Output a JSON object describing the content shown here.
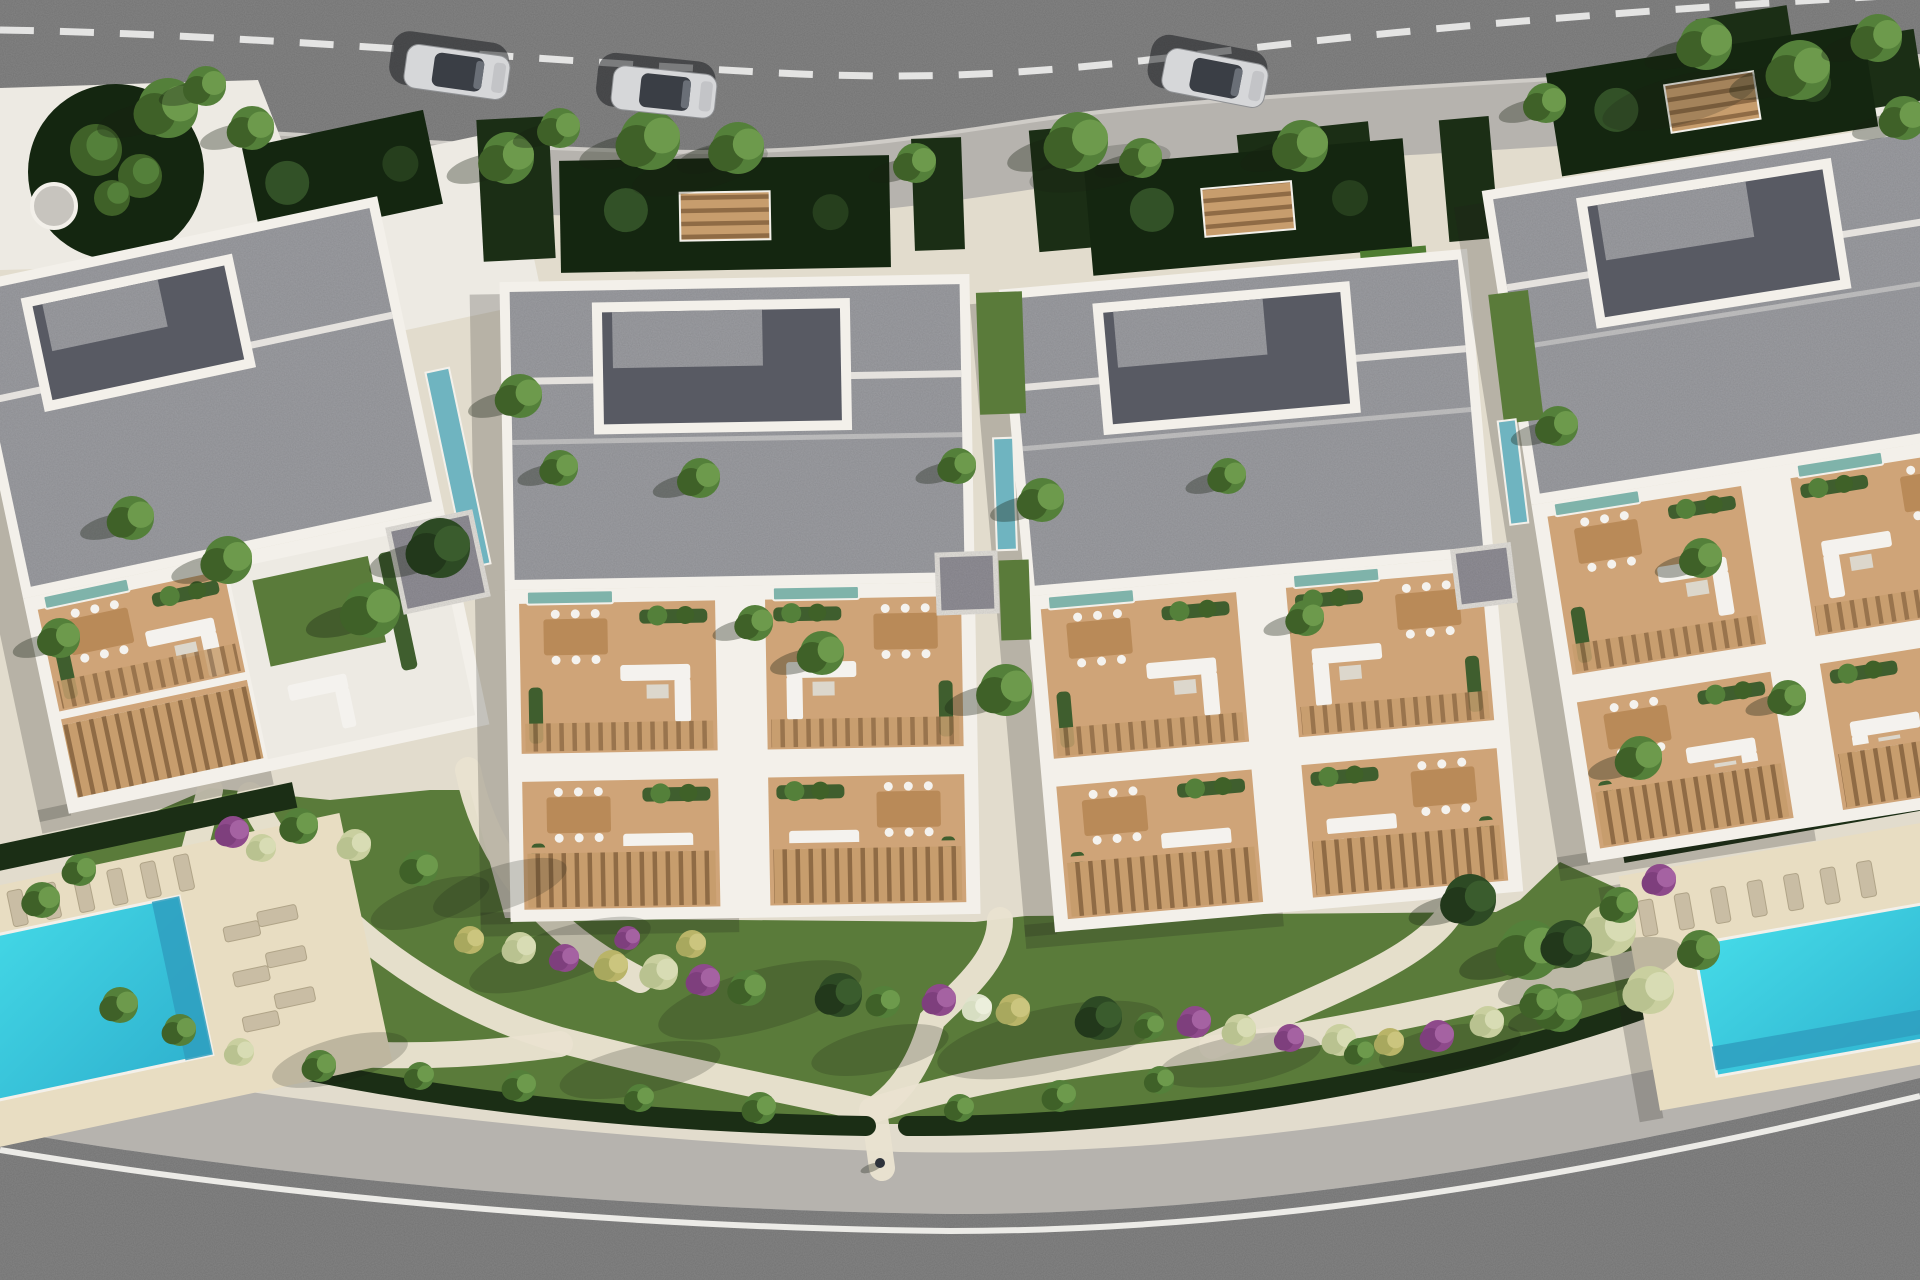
{
  "meta": {
    "title": "Aerial top-down 3D render of a residential apartment complex",
    "view": "top-down site plan visualization",
    "building_count": 4,
    "pool_count": 2,
    "car_count": 3
  },
  "canvas": {
    "w": 1920,
    "h": 1280
  },
  "palette": {
    "asphalt": "#8d8d8d",
    "curb": "#cfccc7",
    "roadDash": "#ededeb",
    "roadLine": "#ecebe7",
    "sidewalk": "#b6b3ae",
    "ground": "#e2dccd",
    "plaza": "#edeae3",
    "wall": "#f3f0ea",
    "roof": "#a8a9ae",
    "roofCourt": "#585a63",
    "courtGarden": "#142610",
    "hedge": "#1b2e15",
    "lawn": "#5a7b3a",
    "lawnBright": "#4e7c31",
    "terrace": "#cfa478",
    "terraceDark": "#b98a58",
    "slatBase": "#c79d6d",
    "slatLine": "#8f6b45",
    "planter": "#3f5e2e",
    "white": "#f4f2ee",
    "furnitureGray": "#dcd7cc",
    "poolLight": "#45dbe8",
    "poolDark": "#2fb2cf",
    "poolDeep": "#2f9fc0",
    "poolTeal": "#6fb4c0",
    "plungeTeal": "#7fb3aa",
    "deck": "#e8ddc2",
    "lounger": "#c9bda4",
    "loungerEdge": "#b0a488",
    "gravel": "#9b99a1",
    "carBody": "#d6d7d9",
    "carTrim": "#8f9194",
    "carGlass": "#3a3e45",
    "carHood": "#c3c4c7",
    "carShadow": "rgba(18,20,24,0.5)",
    "shadow": "rgba(24,32,18,0.40)",
    "buildingShadow": "rgba(30,34,28,0.22)",
    "discGray": "#c7c4be",
    "veg": {
      "g": [
        "#54803a",
        "#3f6128",
        "#6d9a4c"
      ],
      "d": [
        "#2d4a24",
        "#22381b",
        "#3a5c2d"
      ],
      "pale": [
        "#c9cf9f",
        "#b9c290",
        "#d8dcb4"
      ],
      "y": [
        "#b9b468",
        "#a8a85e",
        "#cbc57e"
      ],
      "pu": [
        "#8e4a8b",
        "#7e3f7d",
        "#a562a2"
      ],
      "w": [
        "#dfe3cc",
        "#d7dec2",
        "#ecefdc"
      ]
    }
  },
  "roads": {
    "top": {
      "fill": "M0,0 H1920 V56 C1780,66 1560,78 1400,88 C1250,98 1150,105 1050,118 C950,132 850,152 700,152 C550,152 200,128 0,118 Z",
      "bottomEdge": "M0,118 C200,128 550,152 700,152 C850,152 950,132 1050,118 C1150,105 1250,98 1400,88 C1560,78 1780,66 1920,56",
      "dash": "M0,30 C250,34 550,62 800,74 C950,80 1050,72 1200,54 C1400,30 1600,12 1920,-6",
      "sidewalkBand": "M0,150 C200,160 550,184 700,184 C850,184 960,164 1060,150 C1160,137 1260,130 1410,120 C1570,110 1790,98 1920,88"
    },
    "bottom": {
      "sidewalkFill": "M0,1052 C300,1105 600,1140 900,1152 C1200,1158 1500,1112 1920,1008 L1920,1280 L0,1280 Z",
      "asphaltFill": "M0,1130 C300,1182 650,1210 950,1214 C1250,1214 1550,1165 1920,1078 L1920,1280 L0,1280 Z",
      "whiteLine": "M0,1150 C300,1200 650,1228 950,1231 C1250,1231 1560,1182 1920,1096"
    }
  },
  "cars": [
    {
      "x": 405,
      "y": 50,
      "angle": 8
    },
    {
      "x": 612,
      "y": 70,
      "angle": 6
    },
    {
      "x": 1163,
      "y": 56,
      "angle": 11
    }
  ],
  "person": {
    "x": 880,
    "y": 1163
  },
  "buildings": [
    {
      "id": "building-1",
      "x": 8,
      "y": 235,
      "w": 430,
      "h": 540,
      "rot": -12,
      "variant": "corner",
      "roofH": 320
    },
    {
      "id": "building-2",
      "x": 505,
      "y": 278,
      "w": 470,
      "h": 640,
      "rot": -1,
      "variant": "full",
      "roofH": 290,
      "uh1": 150
    },
    {
      "id": "building-3",
      "x": 1026,
      "y": 268,
      "w": 470,
      "h": 645,
      "rot": -5,
      "variant": "full",
      "roofH": 290,
      "uh1": 150
    },
    {
      "id": "building-4",
      "x": 1532,
      "y": 150,
      "w": 470,
      "h": 680,
      "rot": -9,
      "variant": "full",
      "roofH": 300,
      "uh1": 160
    }
  ],
  "courtGardens": [
    {
      "x": 560,
      "y": 158,
      "w": 330,
      "h": 112,
      "rot": -1,
      "bench": true
    },
    {
      "x": 1088,
      "y": 152,
      "w": 320,
      "h": 110,
      "rot": -5,
      "bench": true
    },
    {
      "x": 1552,
      "y": 48,
      "w": 320,
      "h": 104,
      "rot": -9,
      "bench": true
    },
    {
      "x": 250,
      "y": 128,
      "w": 185,
      "h": 96,
      "rot": -12,
      "bench": false
    }
  ],
  "hedgesTop": [
    [
      480,
      118,
      72,
      142,
      -3
    ],
    [
      913,
      138,
      50,
      112,
      -2
    ],
    [
      1034,
      128,
      54,
      122,
      -5
    ],
    [
      1444,
      118,
      50,
      122,
      -5
    ],
    [
      1240,
      128,
      132,
      70,
      -6
    ],
    [
      1700,
      12,
      92,
      62,
      -9
    ],
    [
      1798,
      38,
      122,
      72,
      -9
    ]
  ],
  "lawnStrips": [
    [
      1852,
      146,
      66,
      286,
      -9
    ],
    [
      1368,
      248,
      66,
      188,
      -5
    ],
    [
      1590,
      326,
      92,
      58,
      -9
    ]
  ],
  "plaza": {
    "shape": "M0,88 L258,80 L304,198 L244,264 L0,270 Z",
    "patch": [
      238,
      158,
      290,
      175,
      -12
    ],
    "rightPath": [
      1876,
      60,
      44,
      420,
      -9
    ],
    "circle": {
      "cx": 116,
      "cy": 172,
      "r": 88
    },
    "disc": {
      "cx": 54,
      "cy": 206,
      "r": 22
    },
    "shrubs": [
      [
        96,
        150,
        26
      ],
      [
        140,
        176,
        22
      ],
      [
        112,
        198,
        18
      ]
    ]
  },
  "lawnMain": "M76,846 L210,788 L330,800 L430,790 L470,790 L505,918 L975,922 L1026,916 L1496,912 L1520,900 L1560,862 L1642,900 L1642,1010 C1450,1082 1150,1122 905,1124 L872,1124 C600,1120 300,1088 76,1002 Z",
  "hedgeBottom": [
    "M60,1002 C300,1090 600,1122 866,1126",
    "M908,1126 C1150,1128 1450,1078 1646,1008"
  ],
  "paths": [
    "M250,795 C300,900 420,1000 560,1040 C700,1076 800,1092 872,1110",
    "M872,1110 C1000,1072 1080,1064 1200,1050 C1350,1032 1500,996 1648,960",
    "M468,770 C480,830 520,920 640,980",
    "M1000,920 C1000,960 962,990 932,1020 C922,1060 902,1092 874,1110",
    "M1452,910 C1422,960 1332,990 1212,1046",
    "M120,1010 C260,1060 420,1064 560,1044",
    "M210,790 C192,860 172,935 152,1005",
    "M874,1110 L882,1168"
  ],
  "corridors": [
    {
      "teal": [
        446,
        368,
        24,
        200
      ],
      "gravel": [
        396,
        520,
        84,
        84
      ],
      "rot": -12,
      "lawns": []
    },
    {
      "teal": [
        995,
        438,
        20,
        112
      ],
      "gravel": [
        938,
        554,
        58,
        58
      ],
      "rot": -2,
      "lawns": [
        [
          978,
          292,
          46,
          122
        ],
        [
          1000,
          560,
          30,
          80
        ]
      ]
    },
    {
      "teal": [
        1504,
        420,
        18,
        104
      ],
      "gravel": [
        1456,
        548,
        56,
        56
      ],
      "rot": -7,
      "lawns": [
        [
          1496,
          292,
          40,
          130
        ]
      ]
    }
  ],
  "pools": [
    {
      "id": "pool-left",
      "rot": -12,
      "cx": 150,
      "cy": 980,
      "deck": [
        -60,
        856,
        430,
        256
      ],
      "hedge": [
        -60,
        816,
        390,
        26
      ],
      "water": [
        -56,
        904,
        252,
        162
      ],
      "deep": [
        168,
        904,
        28,
        162
      ],
      "loungersTop": {
        "x": -40,
        "y": 864,
        "n": 8,
        "dx": 34
      },
      "loungersSide": [
        [
          232,
          944
        ],
        [
          232,
          990
        ],
        [
          232,
          1036
        ]
      ],
      "loungersMid": [
        [
          268,
          936
        ],
        [
          268,
          978
        ],
        [
          268,
          1020
        ]
      ]
    },
    {
      "id": "pool-right",
      "rot": -10,
      "cx": 1800,
      "cy": 960,
      "deck": [
        1636,
        846,
        320,
        238
      ],
      "hedge": [
        1644,
        810,
        300,
        24
      ],
      "water": [
        1698,
        926,
        252,
        134
      ],
      "deep": [
        1698,
        1030,
        252,
        24
      ],
      "loungersTop": {
        "x": 1650,
        "y": 874,
        "n": 7,
        "dx": 37
      },
      "loungersSide": [],
      "loungersMid": []
    }
  ],
  "trees": [
    [
      168,
      108,
      30,
      "g"
    ],
    [
      206,
      86,
      20,
      "g"
    ],
    [
      252,
      128,
      22,
      "g"
    ],
    [
      508,
      158,
      26,
      "g"
    ],
    [
      560,
      128,
      20,
      "g"
    ],
    [
      650,
      140,
      30,
      "g"
    ],
    [
      738,
      148,
      26,
      "g"
    ],
    [
      916,
      163,
      20,
      "g"
    ],
    [
      1078,
      142,
      30,
      "g"
    ],
    [
      1142,
      158,
      20,
      "g"
    ],
    [
      1302,
      146,
      26,
      "g"
    ],
    [
      1546,
      103,
      20,
      "g"
    ],
    [
      1706,
      44,
      26,
      "g"
    ],
    [
      1800,
      70,
      30,
      "g"
    ],
    [
      1878,
      38,
      24,
      "g"
    ],
    [
      1904,
      118,
      22,
      "g"
    ],
    [
      440,
      548,
      30,
      "d"
    ],
    [
      372,
      610,
      28,
      "g"
    ],
    [
      520,
      396,
      22,
      "g"
    ],
    [
      560,
      468,
      18,
      "g"
    ],
    [
      700,
      478,
      20,
      "g"
    ],
    [
      755,
      623,
      18,
      "g"
    ],
    [
      822,
      653,
      22,
      "g"
    ],
    [
      958,
      466,
      18,
      "g"
    ],
    [
      1006,
      690,
      26,
      "g"
    ],
    [
      1042,
      500,
      22,
      "g"
    ],
    [
      1228,
      476,
      18,
      "g"
    ],
    [
      1306,
      618,
      18,
      "g"
    ],
    [
      1558,
      426,
      20,
      "g"
    ],
    [
      1640,
      758,
      22,
      "g"
    ],
    [
      1702,
      558,
      20,
      "g"
    ],
    [
      1788,
      698,
      18,
      "g"
    ],
    [
      132,
      518,
      22,
      "g"
    ],
    [
      228,
      560,
      24,
      "g"
    ],
    [
      60,
      638,
      20,
      "g"
    ],
    [
      1470,
      900,
      26,
      "d"
    ],
    [
      1530,
      950,
      30,
      "g"
    ],
    [
      1610,
      930,
      26,
      "pale"
    ],
    [
      1650,
      990,
      24,
      "pale"
    ],
    [
      1560,
      1010,
      22,
      "g"
    ]
  ],
  "shrubs": [
    [
      233,
      832,
      16,
      "pu"
    ],
    [
      262,
      848,
      14,
      "pale"
    ],
    [
      300,
      826,
      18,
      "g"
    ],
    [
      355,
      845,
      16,
      "pale"
    ],
    [
      420,
      868,
      18,
      "g"
    ],
    [
      120,
      1005,
      18,
      "g"
    ],
    [
      180,
      1030,
      16,
      "g"
    ],
    [
      80,
      870,
      16,
      "g"
    ],
    [
      42,
      900,
      18,
      "g"
    ],
    [
      240,
      1052,
      14,
      "pale"
    ],
    [
      470,
      940,
      14,
      "y"
    ],
    [
      520,
      948,
      16,
      "pale"
    ],
    [
      565,
      958,
      14,
      "pu"
    ],
    [
      612,
      966,
      16,
      "y"
    ],
    [
      660,
      972,
      18,
      "pale"
    ],
    [
      704,
      980,
      16,
      "pu"
    ],
    [
      748,
      988,
      18,
      "g"
    ],
    [
      692,
      944,
      14,
      "y"
    ],
    [
      628,
      938,
      12,
      "pu"
    ],
    [
      840,
      995,
      22,
      "d"
    ],
    [
      884,
      1002,
      16,
      "g"
    ],
    [
      940,
      1000,
      16,
      "pu"
    ],
    [
      978,
      1008,
      14,
      "w"
    ],
    [
      1014,
      1010,
      16,
      "y"
    ],
    [
      1100,
      1018,
      22,
      "d"
    ],
    [
      1150,
      1026,
      14,
      "g"
    ],
    [
      1195,
      1022,
      16,
      "pu"
    ],
    [
      1240,
      1030,
      16,
      "pale"
    ],
    [
      1290,
      1038,
      14,
      "pu"
    ],
    [
      1340,
      1040,
      16,
      "pale"
    ],
    [
      1390,
      1042,
      14,
      "y"
    ],
    [
      1438,
      1036,
      16,
      "pu"
    ],
    [
      1488,
      1022,
      16,
      "pale"
    ],
    [
      1540,
      1002,
      18,
      "g"
    ],
    [
      1568,
      944,
      24,
      "d"
    ],
    [
      1620,
      905,
      18,
      "g"
    ],
    [
      1700,
      950,
      20,
      "g"
    ],
    [
      1660,
      880,
      16,
      "pu"
    ],
    [
      320,
      1066,
      16,
      "g"
    ],
    [
      420,
      1076,
      14,
      "g"
    ],
    [
      520,
      1086,
      16,
      "g"
    ],
    [
      640,
      1098,
      14,
      "g"
    ],
    [
      760,
      1108,
      16,
      "g"
    ],
    [
      960,
      1108,
      14,
      "g"
    ],
    [
      1060,
      1096,
      16,
      "g"
    ],
    [
      1160,
      1080,
      14,
      "g"
    ],
    [
      1360,
      1052,
      14,
      "g"
    ]
  ],
  "shadowEllipses": [
    [
      560,
      955,
      95,
      26,
      -18
    ],
    [
      760,
      1000,
      105,
      30,
      -15
    ],
    [
      1050,
      1040,
      115,
      32,
      -12
    ],
    [
      340,
      1060,
      70,
      22,
      -15
    ],
    [
      640,
      1070,
      82,
      24,
      -12
    ],
    [
      880,
      1050,
      70,
      22,
      -12
    ],
    [
      1240,
      1060,
      82,
      24,
      -10
    ],
    [
      1450,
      1048,
      72,
      22,
      -10
    ],
    [
      1590,
      972,
      95,
      26,
      -15
    ],
    [
      430,
      903,
      62,
      20,
      -18
    ],
    [
      500,
      888,
      70,
      22,
      -18
    ],
    [
      1680,
      100,
      80,
      24,
      -15
    ],
    [
      700,
      170,
      70,
      20,
      -15
    ],
    [
      1100,
      168,
      72,
      20,
      -12
    ]
  ]
}
